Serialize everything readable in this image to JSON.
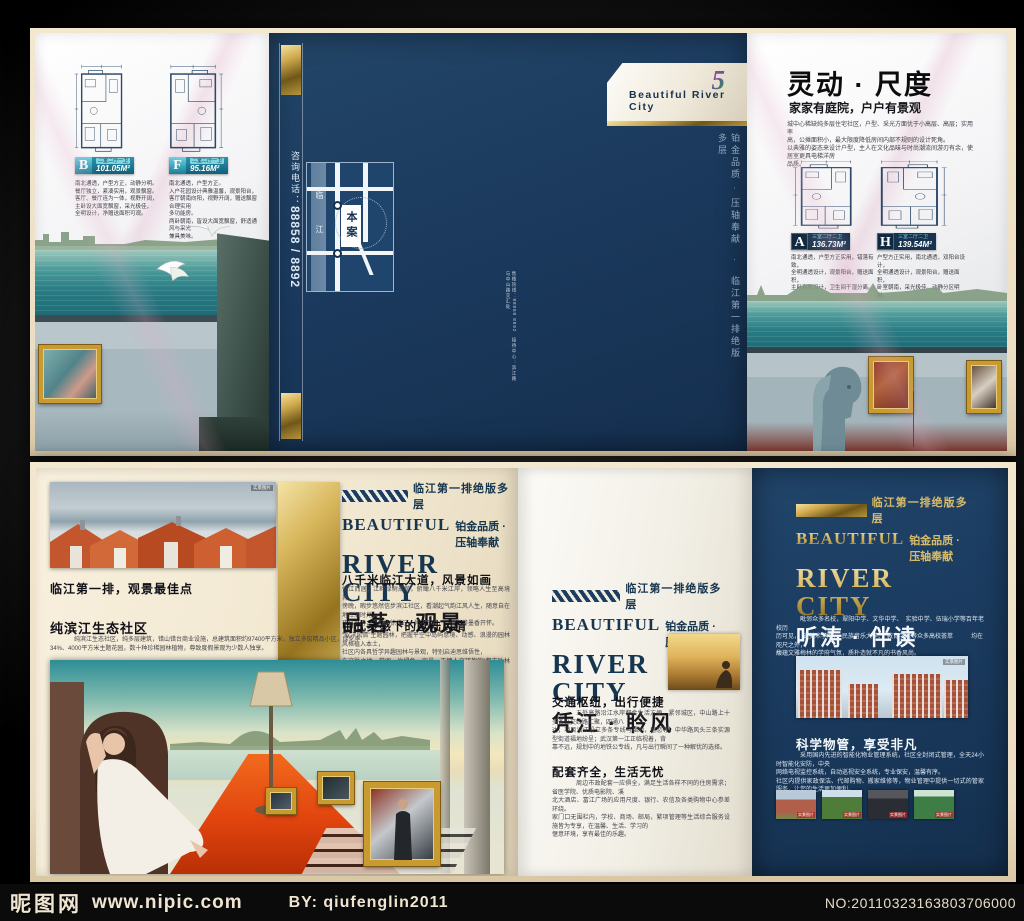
{
  "watermark_bar": {
    "site_name": "昵图网",
    "site_url": "www.nipic.com",
    "author": "BY: qiufenglin2011",
    "serial": "NO:20110323163803706000"
  },
  "brand": {
    "logo_number": "5",
    "name_en": "Beautiful  River City",
    "beautiful": "BEAUTIFUL",
    "river_city": "RIVER  CITY",
    "quality_tag": "铂金品质 · 压轴奉献",
    "position_tag": "临江第一排绝版多层",
    "spine_tagline": "铂金品质 · 压轴奉献　·　临江第一排绝版多层",
    "phone_label": "咨询电话：",
    "phone_numbers": "88858 / 8892",
    "micro_note": "售楼热线：88858 8892　接待中心：滨江路与中山路交汇处"
  },
  "top_spread": {
    "left_panel": {
      "plans": [
        {
          "code": "B",
          "spec": "二室二厅一卫",
          "area": "101.05M²",
          "desc": [
            "南北通透，户型方正，动静分明。",
            "餐厅独立，紧凑实用，观景飘窗。",
            "客厅、餐厅连为一体，视野开阔，",
            "主卧设大面宽飘窗，采光极佳，",
            "全明设计，净赠送面积可观。"
          ]
        },
        {
          "code": "F",
          "spec": "二室二厅一卫",
          "area": "95.16M²",
          "desc": [
            "南北通透，户型方正。",
            "入户花园设计典雅温馨，观景阳台，",
            "客厅朝南向阳，视野开阔，赠送飘窗合理实用",
            "多功能房。",
            "两卧朝南，皆设大面宽飘窗，舒适通风与采光",
            "兼具美味。"
          ]
        }
      ]
    },
    "center_panel": {
      "map": {
        "site_label": "本案",
        "river_label": "临江"
      }
    },
    "right_panel": {
      "title": "灵动 · 尺度",
      "subtitle": "家家有庭院，户户有景观",
      "paragraph": [
        "城中心稀缺纯多层住宅社区，户型、采光方面优于小高层、高层；实用率",
        "高，公摊面积小，最大限度降低房间内部不规则的设计死角。",
        "以典雅的姿态来设计户型，主人在文化品味与时尚潮流间游刃有余，使居室更具电梯洋房",
        "品质。"
      ],
      "plans": [
        {
          "code": "A",
          "spec": "三室二厅二卫",
          "area": "136.73M²",
          "desc": [
            "南北通透，户型方正实用，错落有致，",
            "全明通透设计，观景阳台，赠送面积，",
            "主卧套房设计，卫生间干湿分离。"
          ]
        },
        {
          "code": "H",
          "spec": "三室二厅二卫",
          "area": "139.54M²",
          "desc": [
            "户型方正实用，南北通透，双阳台设计，",
            "全明通透设计，观景阳台，赠送面积，",
            "卧室朝南，采光极佳，动静分区明晰。"
          ]
        }
      ]
    }
  },
  "bottom_spread": {
    "left_sheet": {
      "photo_caption": "临江第一排，观景最佳点",
      "photo_label": "实景图片",
      "section_title": "纯滨江生态社区",
      "section_text": [
        "纯滨江生态社区，纯多层建筑，错山错台商业设施，总建筑面积约97400平方米，独立多层精品小区，绿化率",
        "34%、4000平方米主题花园，数十种珍稀园林植物，尊致度假景观为少数人独享。"
      ],
      "column": {
        "sections": [
          {
            "title": "八千米临江大道，风景如画",
            "lines": [
              "倚江而居，江畔绿树成荫，俯瞰八千米江岸，领略人生至高境界，",
              "傍晚，暇步悠然信步滨江社区，看潮起气韵江风人生，随意自在地挥洒时光，",
              "夜幕之时，江风徐徐拂过，凭栏观景，一卷书卷墨香开怀。"
            ]
          },
          {
            "title": "中式灵感下的欧陆风情",
            "lines": [
              "“取洋风情”主题园林，把握平空中岛屿意境、动感、浪漫的园林风格植入本土，",
              "社区内各具哲学异趣园林与景观，特别启迪思维悟性，",
              "在文脉之地，赏阅一片绿色、宜景，无愧人文环抱的“都市叶林园”。"
            ]
          }
        ]
      }
    },
    "mid_sheet": {
      "sections": [
        {
          "title": "交通枢纽，出行便捷",
          "lines": [
            "五处高路沿江水岸都会生活方便，紧邻城区，中山路上十多条公交线路汇聚，四通八",
            "达，项目沿江设立多条专线与福地，留恋等，中华路风头三条实源型街道福地纷呈；武汉第一江正临视着，背",
            "靠不远，规划中的地铁公专线，凡与出行瞬间了一种解忧的选择。"
          ]
        },
        {
          "title": "配套齐全，生活无忧",
          "lines": [
            "周边市政配套一应俱全，满足生活各样不同的住房需求；省医学院、优质电影院、溪",
            "北大酒店、富江广场的应用尺度、银行、农信及各类购物中心参差环绕。",
            "家门口无围栏内，学校、商场、邮局，繁项管理等生活综合服务设施皆为专享，在温馨、生活、学习的",
            "惬意环境，享有最佳的乐趣。"
          ]
        }
      ]
    },
    "right_sheet": {
      "theme": "听涛 · 伴读",
      "subtitle": "浸润式滨江教育社区",
      "paragraph": [
        "毗邻众多名校，翠阳中学、文华中学、　实验中学、伍瑞小学等百年老校历",
        "历可见，　省美术学院、　民族音乐大学、　教育学院等众多高校荟萃　　　均在",
        "咫尺之外，",
        "馥蕴文雅梅林的学府气氛，质朴造就不凡的书香风尚。"
      ],
      "photo_label": "实景图片",
      "section": {
        "title": "科学物管，享受非凡",
        "lines": [
          "采用国内先进的智能化物业管理系统，社区全封闭式管理，全天24小时智能化安防，中央",
          "网络电视监控系统，自动巡视安全系统，专业保安，温馨有序。",
          "社区内提供家政保洁、代邮购物、搬家维修等，物业管理中提供一切式的管家服务，让您的生活更加便利。"
        ]
      },
      "thumb_labels": [
        "实景图片",
        "实景图片",
        "实景图片",
        "实景图片"
      ]
    },
    "mid_theme": "凭江 · 聆风",
    "left_theme": "品茗 · 观景"
  }
}
